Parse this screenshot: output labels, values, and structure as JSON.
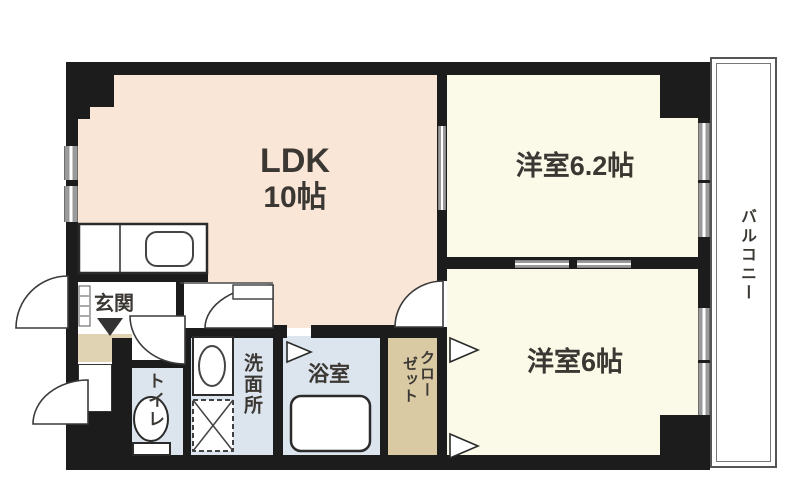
{
  "floorplan": {
    "ldk": {
      "name": "LDK",
      "size": "10帖"
    },
    "bedroom1": {
      "label": "洋室6.2帖"
    },
    "bedroom2": {
      "label": "洋室6帖"
    },
    "balcony": {
      "label": "バルコニー"
    },
    "entrance": {
      "label": "玄関"
    },
    "toilet": {
      "label": "トイレ"
    },
    "washroom": {
      "label": "洗面所"
    },
    "bathroom": {
      "label": "浴室"
    },
    "closet": {
      "label": "クローゼット",
      "label_right_column": "クロー",
      "label_left_column": "ゼット"
    },
    "colors": {
      "ldk_floor": "#f9e6d7",
      "bedroom_floor": "#fbf9e7",
      "wet_area_floor": "#dce5ee",
      "entrance_step": "#e0d3b3",
      "closet_floor": "#d9caa4",
      "wall": "#1c1c1c",
      "window_gray": "#9a9a9a",
      "label_text": "#3b3733"
    }
  }
}
